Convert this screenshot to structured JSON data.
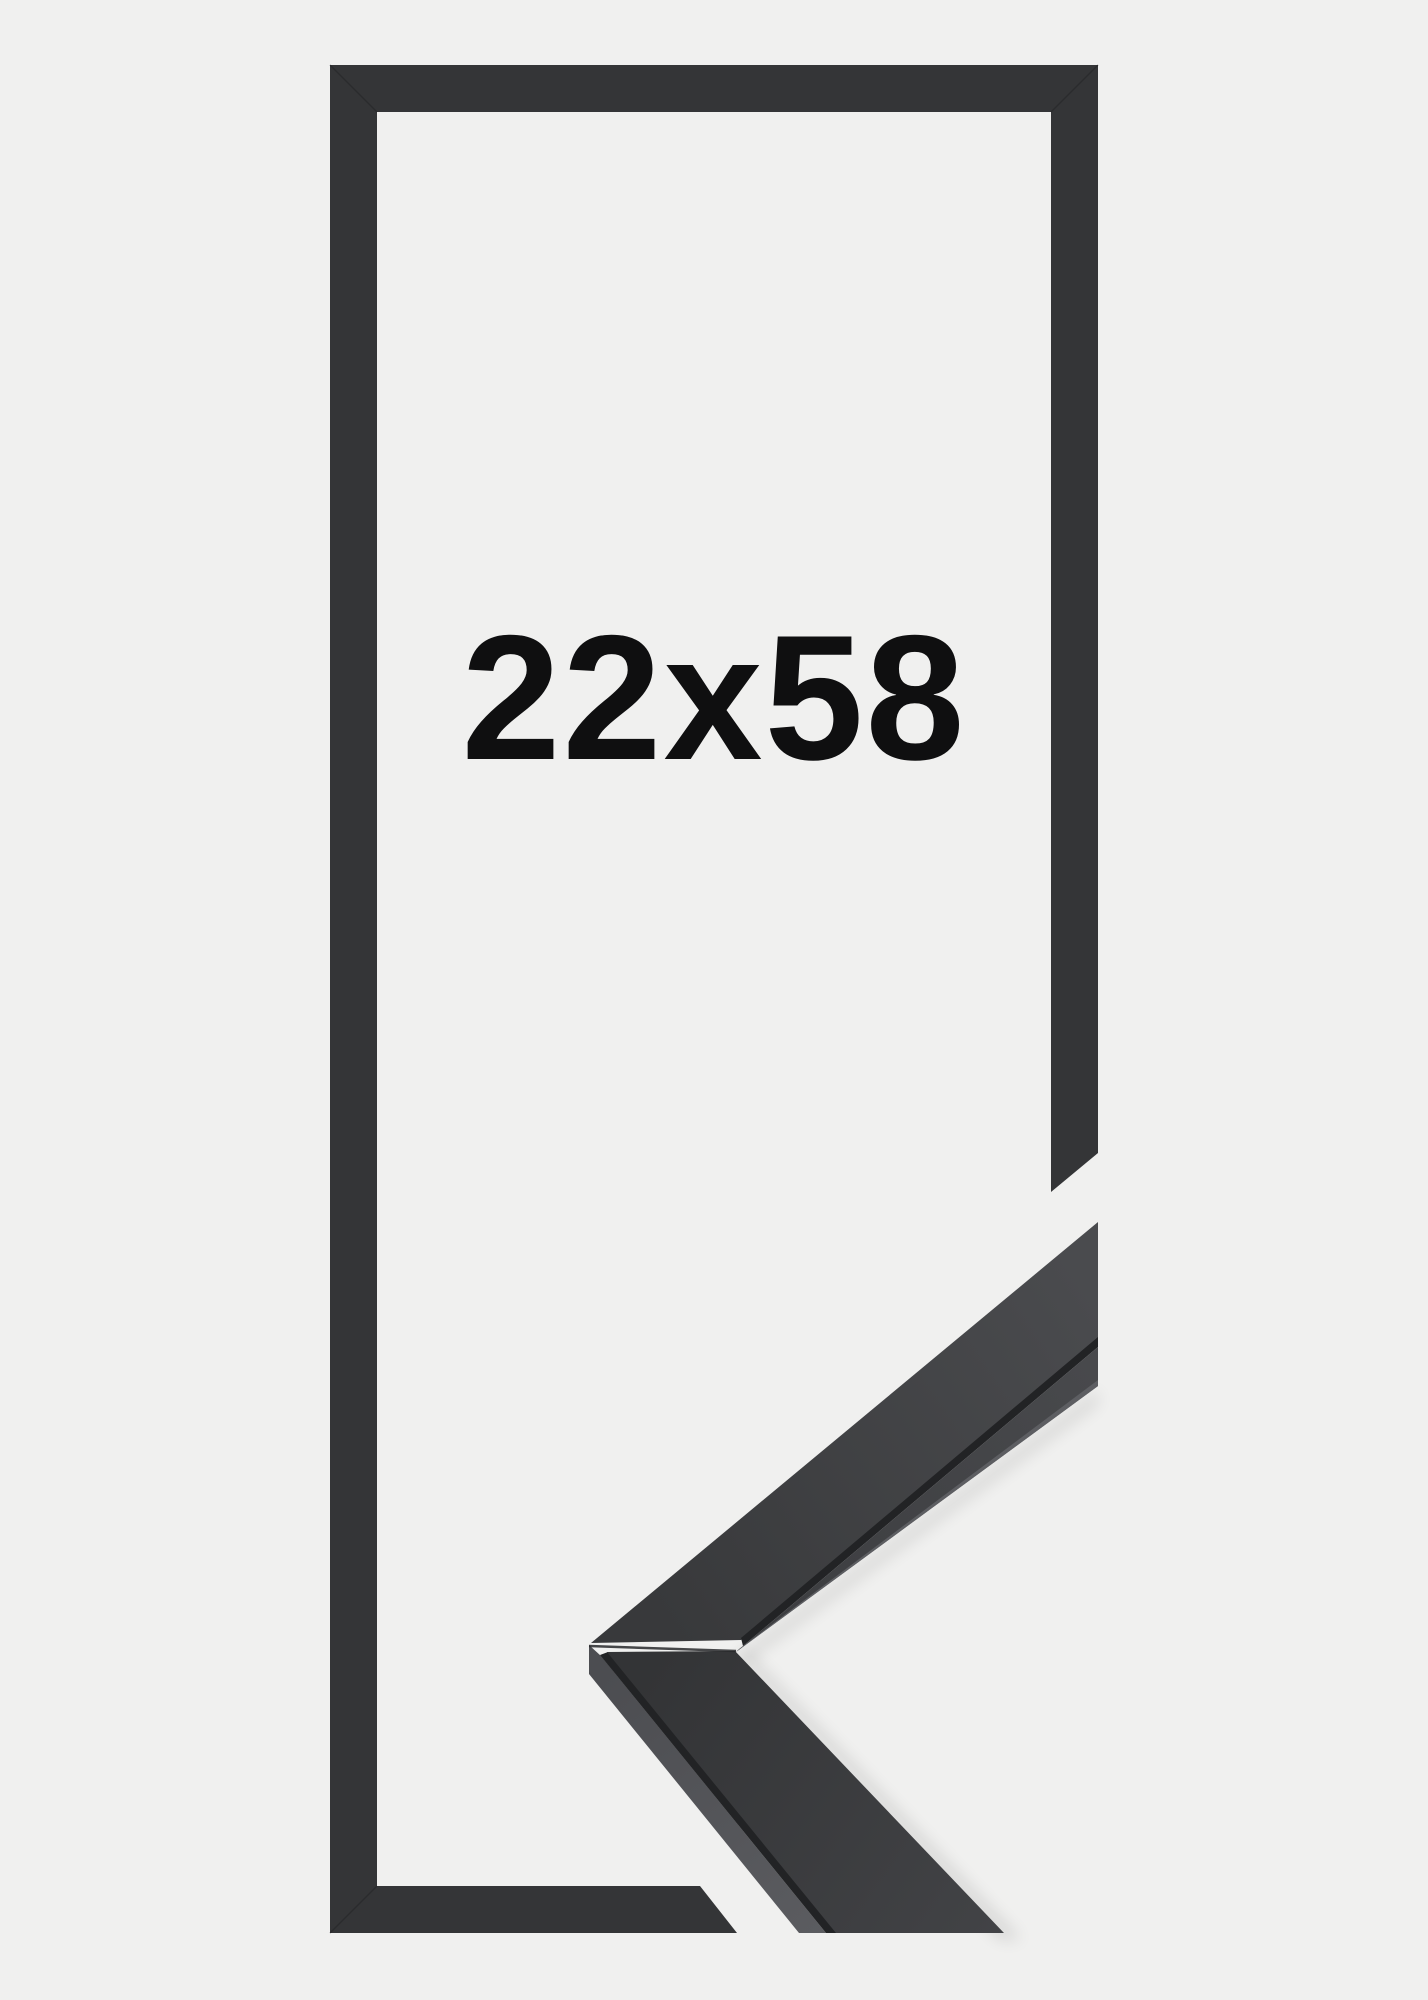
{
  "product": {
    "size_label": "22x58"
  },
  "colors": {
    "background": "#f0f0ef",
    "frame": "#343537",
    "frame_miter": "#232426",
    "label_text": "#0f0f10",
    "sample_top_dark": "#38393b",
    "sample_top_light": "#4a4b4e",
    "sample_front_dark": "#3c3d40",
    "sample_front_light": "#48494c",
    "sample_front_highlight": "#5d5e62",
    "sample_outer_dark": "#4c4d51",
    "sample_outer_light": "#5b5c60",
    "sample_lower_top_dark": "#333436",
    "sample_lower_top_light": "#424346",
    "sample_crease": "#222325",
    "sample_seam": "#28292b",
    "shadow": "#000000"
  }
}
